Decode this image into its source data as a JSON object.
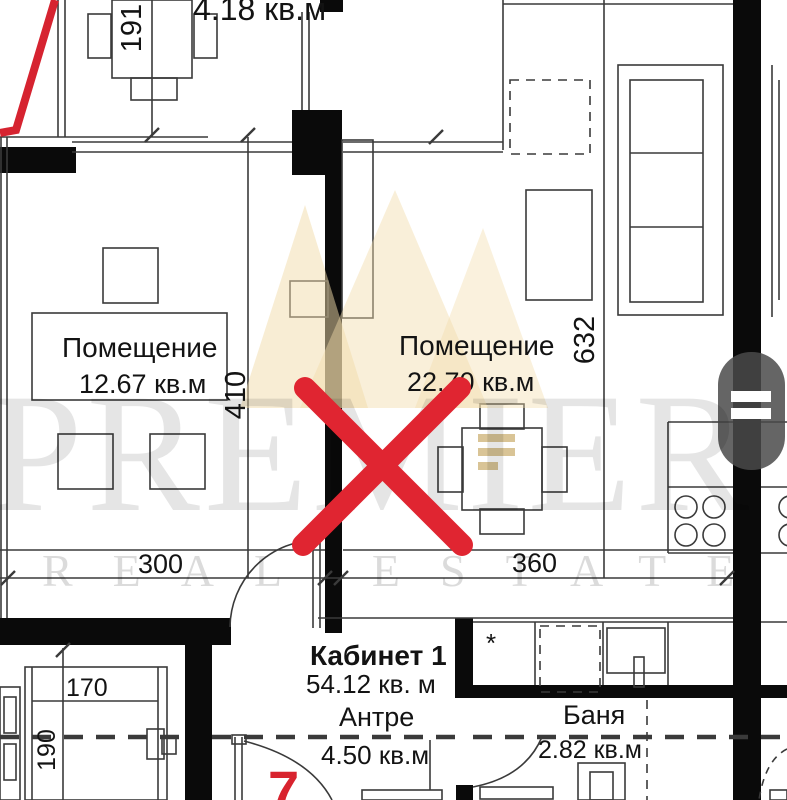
{
  "floorplan": {
    "unit": {
      "name": "Кабинет 1",
      "area": "54.12 кв. м",
      "number": "7"
    },
    "terrace": {
      "area": "4.18 кв.м",
      "width_dim": "191"
    },
    "room_left": {
      "name": "Помещение",
      "area": "12.67 кв.м",
      "width_dim": "300",
      "height_dim": "410"
    },
    "room_right": {
      "name": "Помещение",
      "area": "22.70 кв.м",
      "width_dim": "360",
      "height_dim": "632"
    },
    "hallway": {
      "name": "Антре",
      "area": "4.50 кв.м"
    },
    "bathroom": {
      "name": "Баня",
      "area": "2.82 кв.м"
    },
    "bedroom": {
      "width_dim": "170",
      "height_dim": "190"
    },
    "kitchen": {
      "note": "*"
    },
    "watermark": {
      "brand": "PREMIER",
      "tagline": "REAL ESTATE"
    },
    "colors": {
      "marker_red": "#e02531",
      "wall": "#0a0a0a",
      "crown_gold": "#f2dbaa"
    }
  }
}
